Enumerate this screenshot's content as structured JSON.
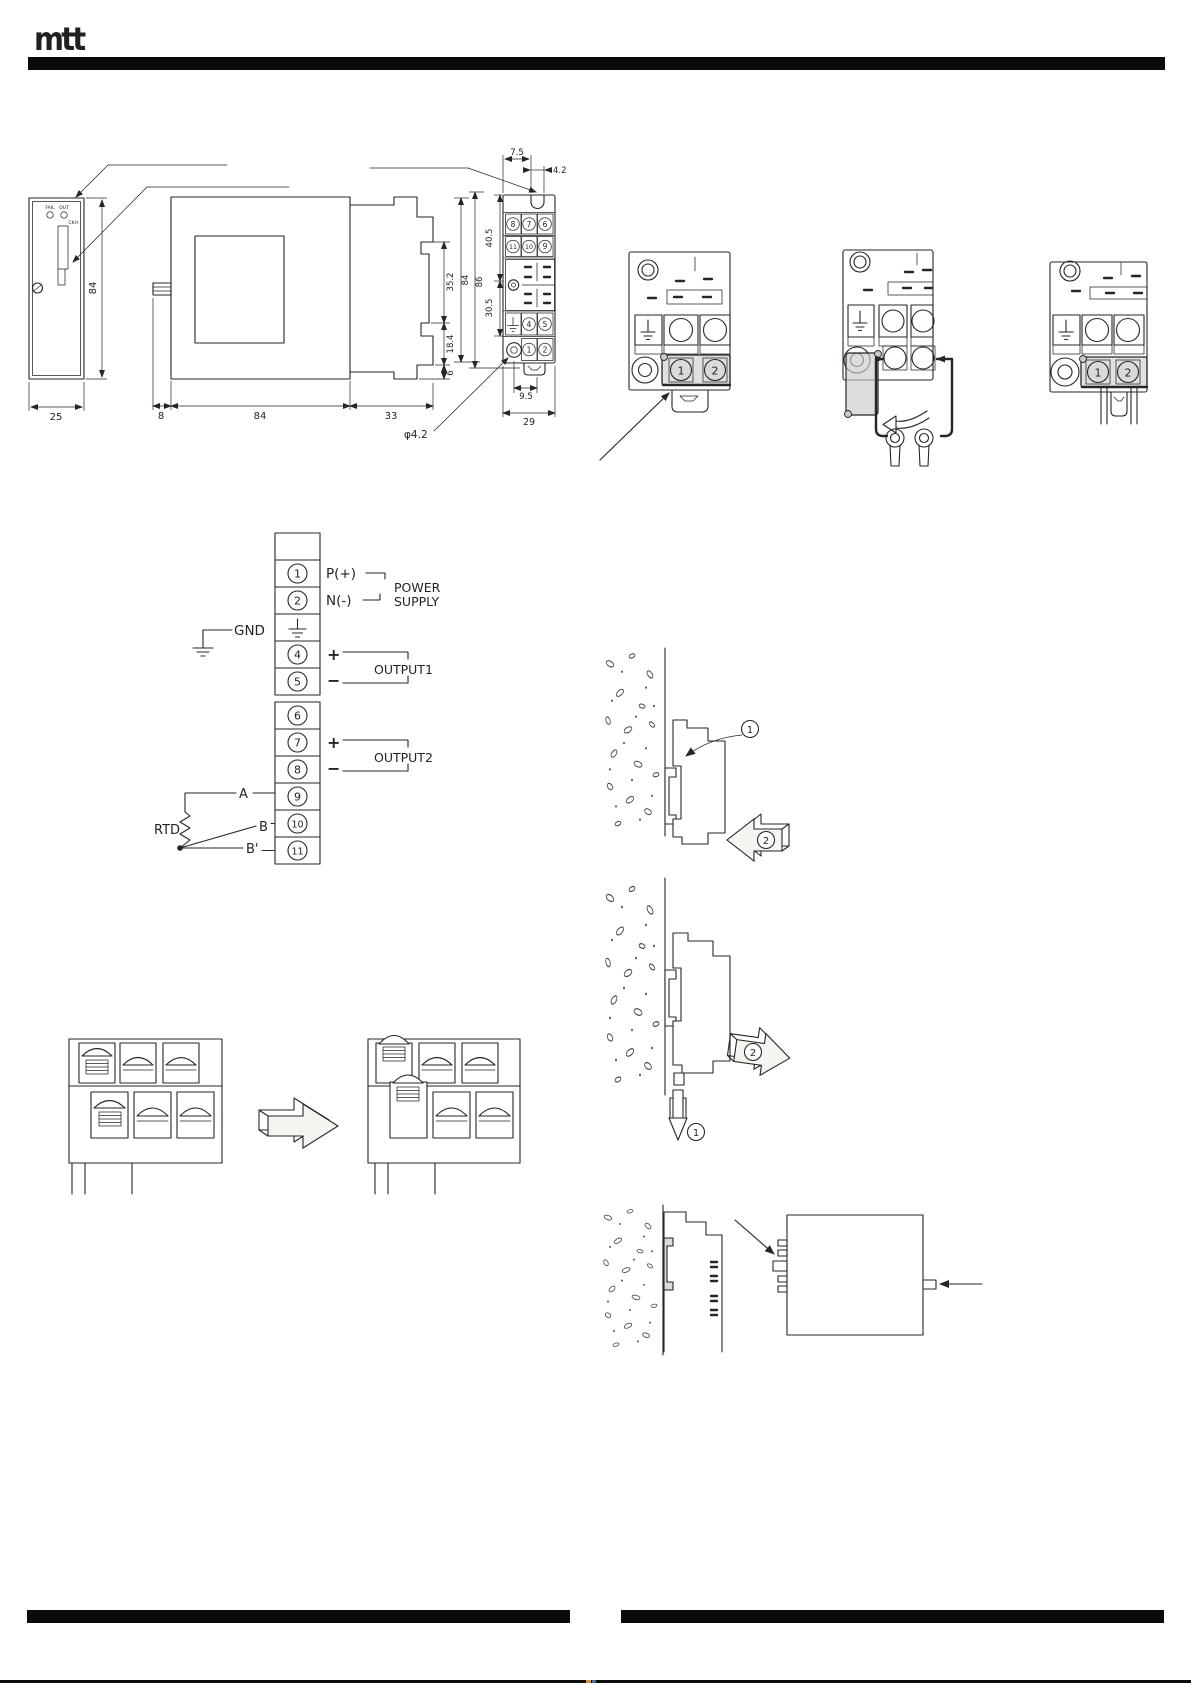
{
  "header": {
    "logo": "mtt"
  },
  "dimension_views": {
    "front": {
      "led_left": "FAIL",
      "led_right": "OUT",
      "panel_label": "CKH",
      "height": "84",
      "width": "25"
    },
    "bottom_dims": {
      "tab": "8",
      "body": "84",
      "terminal_block": "33"
    },
    "profile_dims": {
      "rail_slot": "35.2",
      "below_rail": "18.4",
      "foot": "6"
    },
    "rear": {
      "hole_offset": "7.5",
      "hole_width": "4.2",
      "upper_span": "40.5",
      "lower_span": "30.5",
      "height_inner": "84",
      "height_outer": "86",
      "hole_to_center": "9.5",
      "width": "29",
      "hole_diameter": "φ4.2",
      "terminals_row1": [
        "8",
        "7",
        "6"
      ],
      "terminals_row2": [
        "11",
        "10",
        "9"
      ],
      "terminals_row3": [
        "4",
        "5"
      ],
      "terminals_row4": [
        "1",
        "2"
      ]
    }
  },
  "terminal_block_steps": {
    "terminal1": "1",
    "terminal2": "2"
  },
  "connection_diagram": {
    "terminals": {
      "t1": "1",
      "t2": "2",
      "t4": "4",
      "t5": "5",
      "t6": "6",
      "t7": "7",
      "t8": "8",
      "t9": "9",
      "t10": "10",
      "t11": "11"
    },
    "power_positive": "P(+)",
    "power_negative": "N(-)",
    "power_supply_line1": "POWER",
    "power_supply_line2": "SUPPLY",
    "ground": "GND",
    "output1_plus": "+",
    "output1_minus": "−",
    "output1_label": "OUTPUT1",
    "output2_plus": "+",
    "output2_minus": "−",
    "output2_label": "OUTPUT2",
    "sensor_label": "RTD",
    "wire_a": "A",
    "wire_b": "B",
    "wire_b_prime": "B'"
  },
  "mounting_steps": {
    "step1": "1",
    "step2": "2"
  },
  "colors": {
    "ink": "#2a2522",
    "cover_gray": "#c9cbc9",
    "arrow_fill": "#f3f5f0",
    "footer_tick_orange": "#d99a2b",
    "footer_tick_blue": "#4a66a0"
  }
}
